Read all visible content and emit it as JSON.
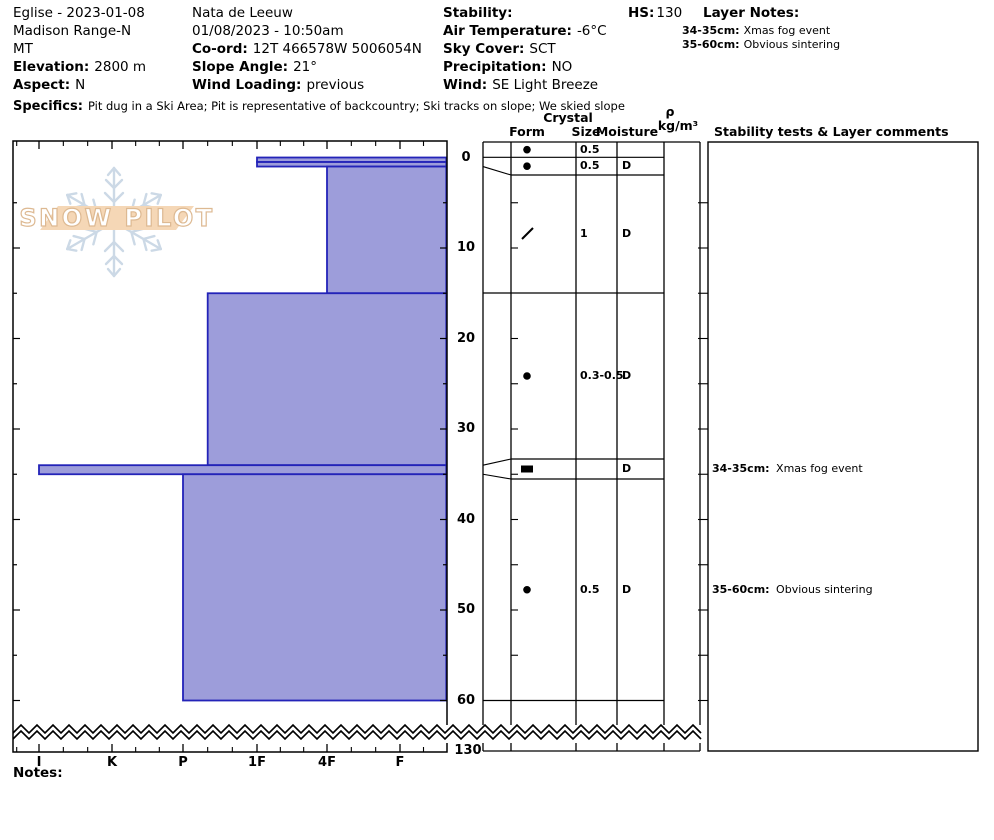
{
  "header": {
    "col1": {
      "title": "Eglise - 2023-01-08",
      "range": "Madison Range-N",
      "state": "MT",
      "elevation_label": "Elevation:",
      "elevation": "2800 m",
      "aspect_label": "Aspect:",
      "aspect": "N"
    },
    "col2": {
      "observer": "Nata de Leeuw",
      "datetime": "01/08/2023 - 10:50am",
      "coord_label": "Co-ord:",
      "coord": "12T 466578W 5006054N",
      "slope_label": "Slope Angle:",
      "slope": "21°",
      "wind_loading_label": "Wind Loading:",
      "wind_loading": "previous"
    },
    "col3": {
      "stability_label": "Stability:",
      "air_temp_label": "Air Temperature:",
      "air_temp": "-6°C",
      "sky_label": "Sky Cover:",
      "sky": "SCT",
      "precip_label": "Precipitation:",
      "precip": "NO",
      "wind_label": "Wind:",
      "wind": "SE Light Breeze"
    },
    "hs_label": "HS:",
    "hs": "130",
    "layer_notes_label": "Layer Notes:",
    "layer_notes": [
      {
        "range": "34-35cm:",
        "text": "Xmas fog event"
      },
      {
        "range": "35-60cm:",
        "text": "Obvious sintering"
      }
    ],
    "specifics_label": "Specifics:",
    "specifics": "Pit dug in a Ski Area;  Pit is representative of backcountry;  Ski tracks on slope;  We skied slope"
  },
  "columns": {
    "crystal": "Crystal",
    "form": "Form",
    "size": "Size",
    "moisture": "Moisture",
    "rho": "ρ",
    "rho_units": "kg/m³",
    "stability_tests": "Stability tests & Layer comments"
  },
  "watermark": "SNOW PILOT",
  "notes_label": "Notes:",
  "chart_data": {
    "type": "bar",
    "subtype": "snowpit-hardness-profile",
    "title": "SnowPilot hand-hardness profile, depth vs hardness",
    "hardness_labels": [
      "I",
      "K",
      "P",
      "1F",
      "4F",
      "F"
    ],
    "depth_axis": {
      "unit": "cm",
      "surface": 0,
      "shown_to": 60,
      "total_depth": 130,
      "tick_interval": 5,
      "label_interval": 10,
      "depth_labels": [
        "0",
        "10",
        "20",
        "30",
        "40",
        "50",
        "60"
      ],
      "bottom_label": "130"
    },
    "layers": [
      {
        "top_cm": 0,
        "bottom_cm": 0.5,
        "hardness": "1F",
        "grain_form": "rounded-dot",
        "grain_size_mm": "0.5",
        "moisture": ""
      },
      {
        "top_cm": 0.5,
        "bottom_cm": 1,
        "hardness": "1F",
        "grain_form": "rounded-dot",
        "grain_size_mm": "0.5",
        "moisture": "D"
      },
      {
        "top_cm": 1,
        "bottom_cm": 15,
        "hardness": "4F",
        "grain_form": "decomposing-slash",
        "grain_size_mm": "1",
        "moisture": "D"
      },
      {
        "top_cm": 15,
        "bottom_cm": 34,
        "hardness": "P-",
        "grain_form": "rounded-dot",
        "grain_size_mm": "0.3-0.5",
        "moisture": "D"
      },
      {
        "top_cm": 34,
        "bottom_cm": 35,
        "hardness": "I",
        "grain_form": "ice-lens",
        "grain_size_mm": "",
        "moisture": "D"
      },
      {
        "top_cm": 35,
        "bottom_cm": 60,
        "hardness": "P",
        "grain_form": "rounded-dot",
        "grain_size_mm": "0.5",
        "moisture": "D"
      }
    ],
    "layer_comments": [
      {
        "layer_index": 4,
        "range": "34-35cm:",
        "text": "Xmas fog event"
      },
      {
        "layer_index": 5,
        "range": "35-60cm:",
        "text": "Obvious sintering"
      }
    ],
    "bar_color": "#9d9dda",
    "bar_border_color": "#2323b8",
    "legend": "hardest (I) at left, softest (F) at right; bars grow leftward from right edge"
  }
}
